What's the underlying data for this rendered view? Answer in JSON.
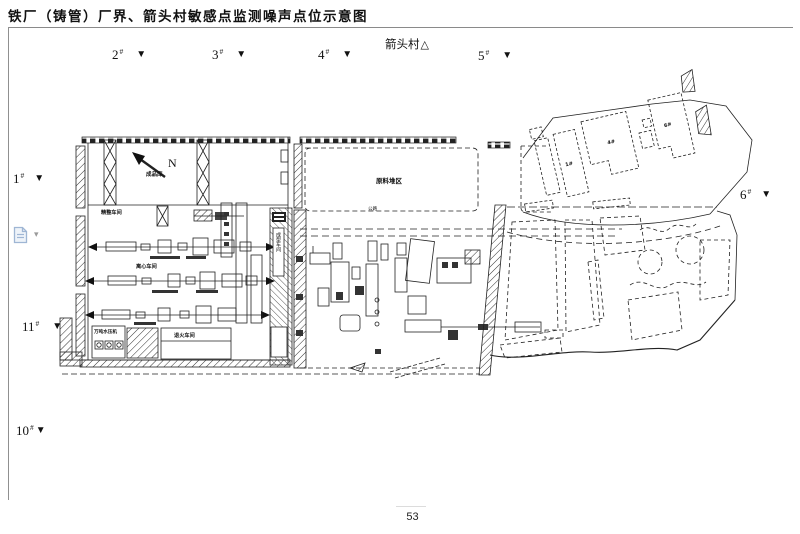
{
  "page": {
    "title": "铁厂（铸管）厂界、箭头村敏感点监测噪声点位示意图",
    "page_number": "53"
  },
  "village_marker": {
    "label": "箭头村",
    "symbol": "△"
  },
  "monitoring_points": [
    {
      "id": "point-2",
      "label": "2",
      "sup": "#",
      "symbol": "▼"
    },
    {
      "id": "point-3",
      "label": "3",
      "sup": "#",
      "symbol": "▼"
    },
    {
      "id": "point-4",
      "label": "4",
      "sup": "#",
      "symbol": "▼"
    },
    {
      "id": "point-5",
      "label": "5",
      "sup": "#",
      "symbol": "▼"
    },
    {
      "id": "point-1",
      "label": "1",
      "sup": "#",
      "symbol": "▼"
    },
    {
      "id": "point-6",
      "label": "6",
      "sup": "#",
      "symbol": "▼"
    },
    {
      "id": "point-11",
      "label": "11",
      "sup": "#",
      "symbol": "▼"
    },
    {
      "id": "point-10",
      "label": "10",
      "sup": "#",
      "symbol": "▼"
    }
  ],
  "map": {
    "north_label": "N",
    "compass_caption": "成品库",
    "stockyard_label": "原料堆区",
    "road_label": "公路",
    "workshops": {
      "line1": "精整车间",
      "line2": "离心车间",
      "line3": "退火车间",
      "press_room": "万吨水压机",
      "gallery": "成型车间"
    },
    "building_numbers": [
      "1#",
      "4#",
      "6#"
    ]
  },
  "word_ui": {
    "comment_dropdown": "▾"
  }
}
